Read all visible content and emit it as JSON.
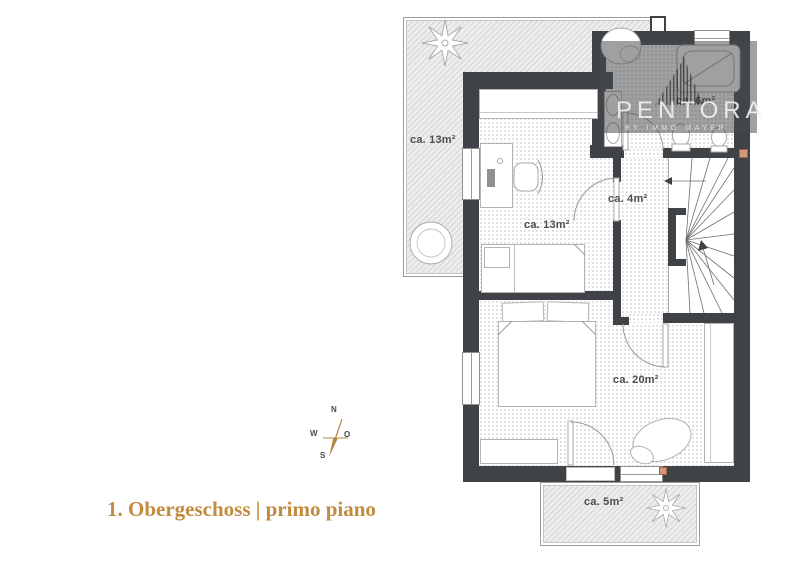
{
  "title": {
    "text": "1. Obergeschoss | primo piano"
  },
  "watermark": {
    "brand": "PENTORA",
    "tagline": "BY IMMO MAYER"
  },
  "compass": {
    "n": "N",
    "w": "W",
    "o": "O",
    "s": "S"
  },
  "rooms": {
    "terrace": {
      "label": "ca. 13m²"
    },
    "bedroom_small": {
      "label": "ca. 13m²"
    },
    "bathroom": {
      "label": "ca. 6m²"
    },
    "hall": {
      "label": "ca. 4m²"
    },
    "bedroom_master": {
      "label": "ca. 20m²"
    },
    "balcony": {
      "label": "ca. 5m²"
    }
  },
  "colors": {
    "wall": "#3f4347",
    "accent_gold": "#c18c3e",
    "floor_dot": "#d8d8d8"
  }
}
